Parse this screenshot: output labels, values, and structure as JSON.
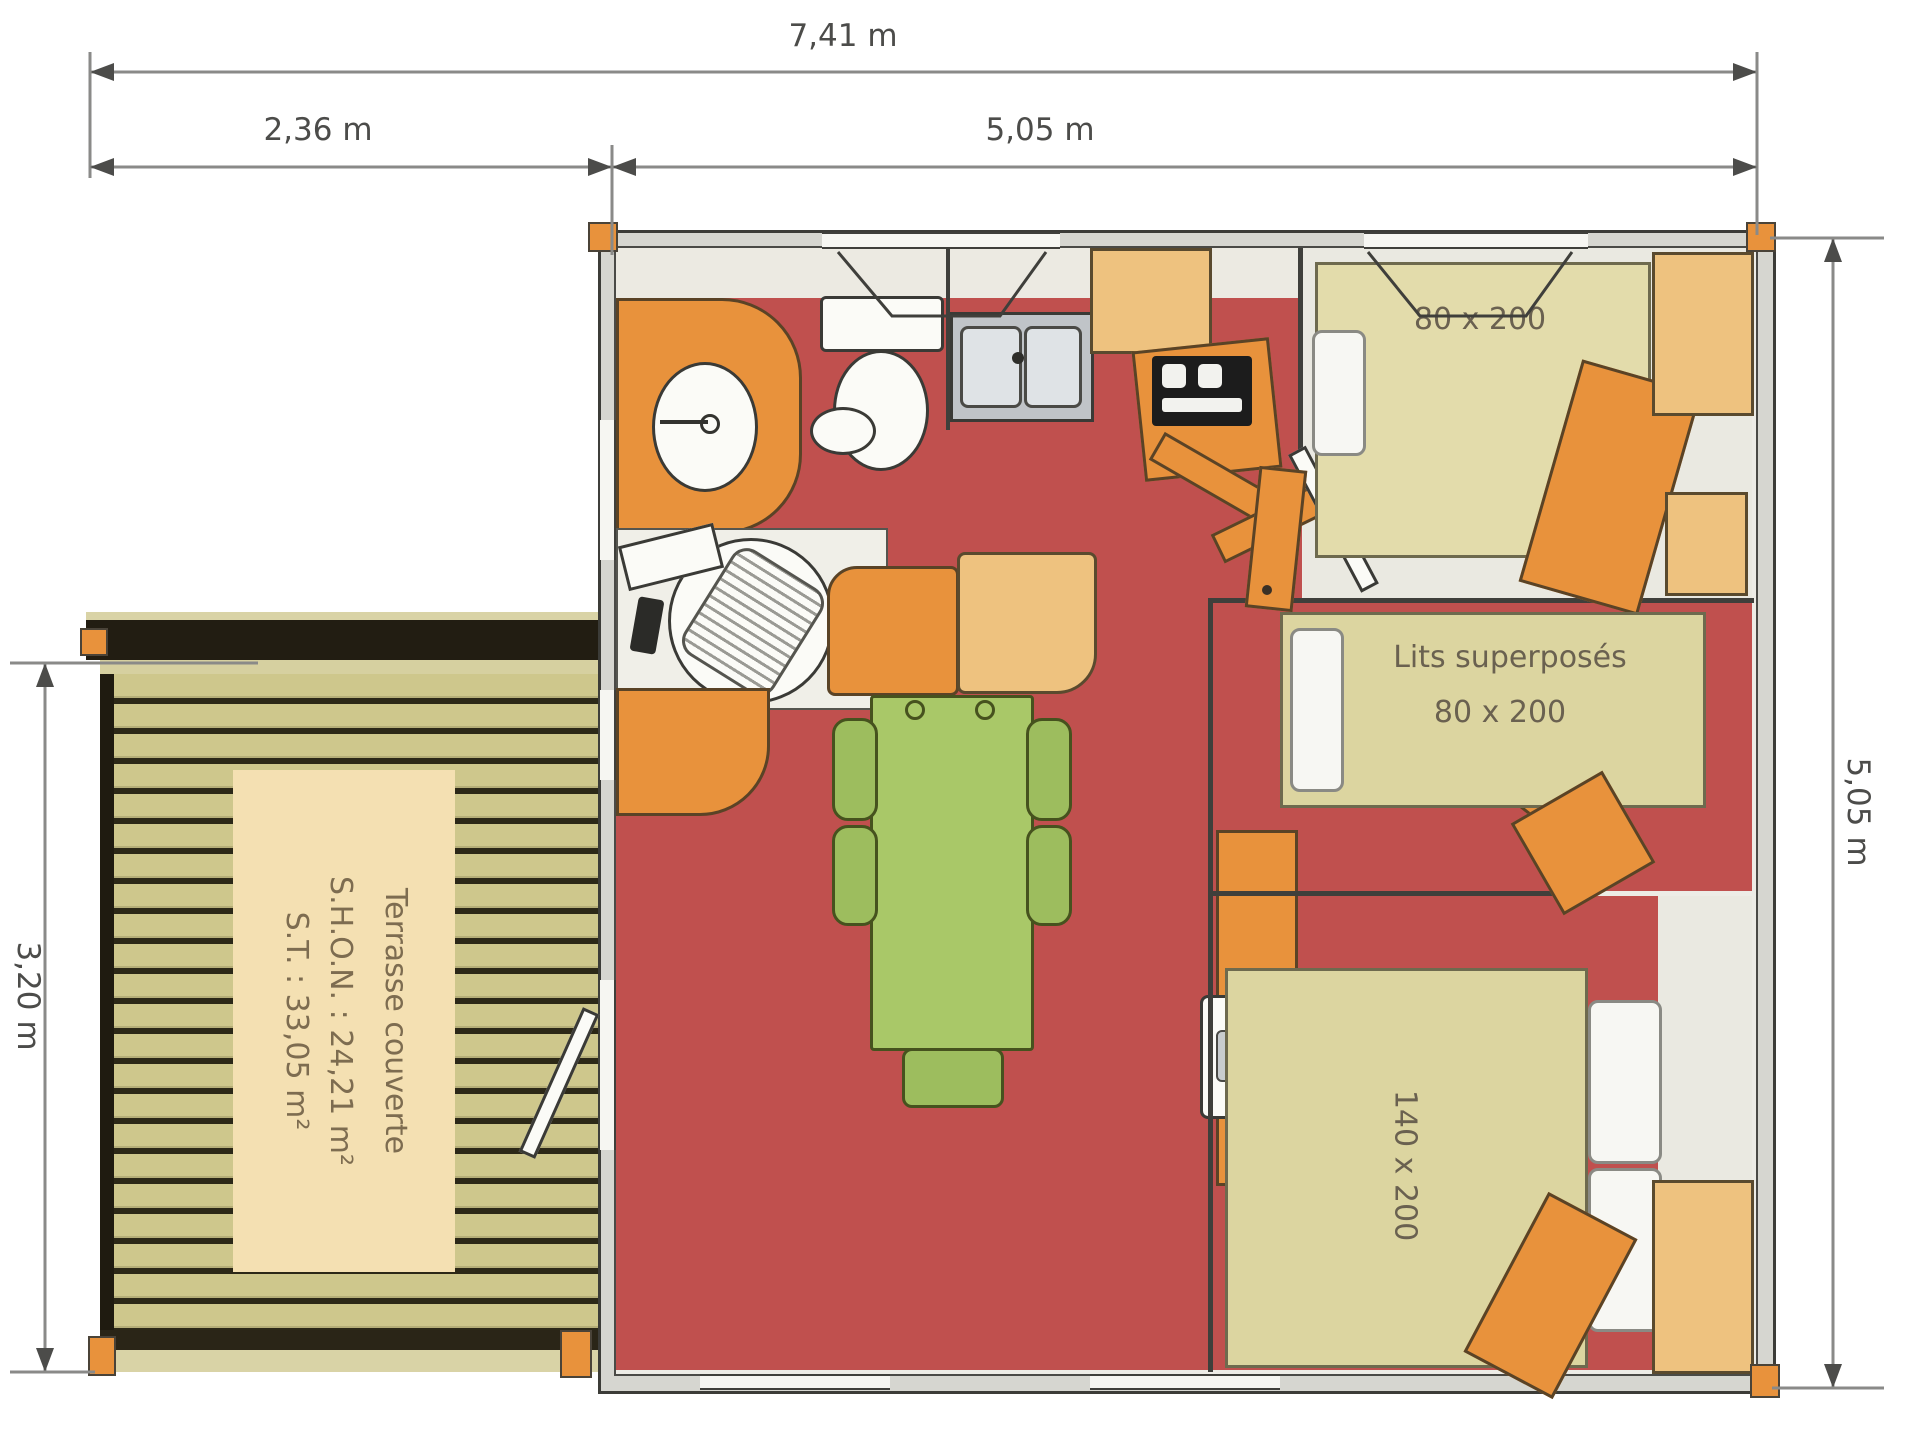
{
  "dimensions": {
    "total_width": "7,41 m",
    "terrace_width": "2,36 m",
    "building_width": "5,05 m",
    "building_depth": "5,05 m",
    "terrace_depth": "3,20 m"
  },
  "terrace": {
    "label_line1": "Terrasse couverte",
    "label_line2": "S.H.O.N. : 24,21 m²",
    "label_line3": "S.T. : 33,05 m²"
  },
  "rooms": {
    "bedroom_single_bed": "80 x 200",
    "bunk_room_label": "Lits superposés",
    "bunk_room_size": "80 x 200",
    "bedroom_double_bed": "140 x 200"
  },
  "colors": {
    "floor_red": "#c0504e",
    "furniture_orange": "#e8923c",
    "bed_khaki": "#dcd5a0",
    "cabinet_tan": "#eec27f",
    "terrace_plank": "#cec78c",
    "table_green": "#a9c868",
    "wall_gray": "#d6d6d0"
  }
}
